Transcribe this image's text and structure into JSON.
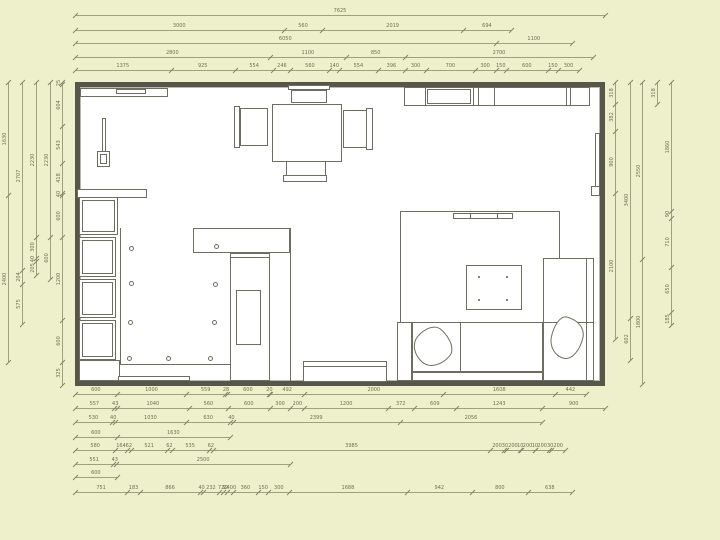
{
  "colors": {
    "background": "#eef0cb",
    "paper": "#ffffff",
    "wall": "#56564b",
    "furniture_line": "#6e6e60",
    "dimension_line": "#a0a080",
    "dimension_text": "#6f6f55"
  },
  "plan": {
    "x": 75,
    "y": 82,
    "w": 530,
    "h": 304,
    "scale_px_per_mm": 0.06951
  },
  "dims": {
    "top": [
      {
        "y": 15,
        "values": [
          7625
        ]
      },
      {
        "y": 30,
        "values": [
          3000,
          560,
          2019,
          694
        ]
      },
      {
        "y": 43,
        "values": [
          6050,
          1100
        ]
      },
      {
        "y": 57,
        "values": [
          2800,
          1100,
          850,
          2700
        ]
      },
      {
        "y": 70,
        "values": [
          1375,
          925,
          554,
          246,
          560,
          140,
          554,
          396,
          300,
          700,
          300,
          150,
          600,
          150,
          300
        ]
      }
    ],
    "bottom": [
      {
        "y": 394,
        "values": [
          600,
          1000,
          559,
          28,
          600,
          20,
          492,
          2000,
          1608,
          442
        ]
      },
      {
        "y": 408,
        "values": [
          557,
          43,
          1040,
          560,
          600,
          300,
          200,
          1200,
          372,
          609,
          1243,
          900
        ]
      },
      {
        "y": 422,
        "values": [
          530,
          40,
          1030,
          630,
          40,
          2399,
          2056
        ]
      },
      {
        "y": 437,
        "values": [
          600,
          1630
        ]
      },
      {
        "y": 450,
        "values": [
          580,
          164,
          62,
          521,
          62,
          535,
          62,
          3985,
          200,
          30,
          200,
          10,
          200,
          10,
          200,
          30,
          200
        ]
      },
      {
        "y": 464,
        "values": [
          551,
          43,
          2500
        ]
      },
      {
        "y": 477,
        "values": [
          600
        ]
      },
      {
        "y": 492,
        "values": [
          751,
          183,
          866,
          40,
          232,
          {
            "mm": 60,
            "label": "72"
          },
          {
            "mm": 50,
            "label": "32"
          },
          {
            "mm": 90,
            "label": "2400"
          },
          360,
          150,
          300,
          1688,
          942,
          800,
          638
        ]
      }
    ],
    "left": [
      {
        "x": 8,
        "values": [
          1630,
          2400
        ]
      },
      {
        "x": 22,
        "values": [
          2707,
          204,
          575
        ]
      },
      {
        "x": 36,
        "values": [
          2230,
          300,
          40,
          205
        ]
      },
      {
        "x": 50,
        "values": [
          2230,
          600
        ]
      },
      {
        "x": 62,
        "values": [
          25,
          604,
          543,
          418,
          40,
          600,
          1200,
          600,
          325
        ]
      }
    ],
    "right": [
      {
        "x": 615,
        "values": [
          318,
          382,
          900,
          2100
        ]
      },
      {
        "x": 630,
        "values": [
          3400,
          602
        ]
      },
      {
        "x": 642,
        "values": [
          2550,
          1800
        ]
      },
      {
        "x": 657,
        "values": [
          318
        ]
      },
      {
        "x": 671,
        "values": [
          1860,
          90,
          710,
          650,
          185
        ]
      }
    ]
  },
  "furniture": [
    {
      "name": "window-shelf",
      "type": "rect",
      "x": 80,
      "y": 88,
      "w": 88,
      "h": 9
    },
    {
      "name": "window-shelf-detail",
      "type": "rect",
      "x": 116,
      "y": 89,
      "w": 30,
      "h": 5
    },
    {
      "name": "wall-lamp-stem",
      "type": "rect",
      "x": 102,
      "y": 118,
      "w": 4,
      "h": 46
    },
    {
      "name": "wall-lamp-base",
      "type": "rect",
      "x": 97,
      "y": 151,
      "w": 13,
      "h": 16,
      "inner": true
    },
    {
      "name": "side-table",
      "type": "rect",
      "x": 77,
      "y": 189,
      "w": 70,
      "h": 9
    },
    {
      "name": "dining-table",
      "type": "rect",
      "x": 272,
      "y": 104,
      "w": 70,
      "h": 58
    },
    {
      "name": "chair-top-back",
      "type": "rect",
      "x": 288,
      "y": 85,
      "w": 42,
      "h": 5
    },
    {
      "name": "chair-top-seat",
      "type": "rect",
      "x": 291,
      "y": 90,
      "w": 36,
      "h": 13
    },
    {
      "name": "chair-left-back",
      "type": "rect",
      "x": 234,
      "y": 106,
      "w": 6,
      "h": 42
    },
    {
      "name": "chair-left-seat",
      "type": "rect",
      "x": 240,
      "y": 108,
      "w": 28,
      "h": 38
    },
    {
      "name": "chair-right-back",
      "type": "rect",
      "x": 366,
      "y": 108,
      "w": 7,
      "h": 42
    },
    {
      "name": "chair-right-seat",
      "type": "rect",
      "x": 343,
      "y": 110,
      "w": 24,
      "h": 38
    },
    {
      "name": "chair-bottom-back",
      "type": "rect",
      "x": 283,
      "y": 175,
      "w": 44,
      "h": 7
    },
    {
      "name": "chair-bottom-seat",
      "type": "rect",
      "x": 286,
      "y": 161,
      "w": 40,
      "h": 15
    },
    {
      "name": "kitchen-cabinet-row",
      "type": "rect",
      "x": 404,
      "y": 87,
      "w": 186,
      "h": 19
    },
    {
      "name": "cabinet-divider",
      "type": "line",
      "x": 425,
      "y": 87,
      "w": 1,
      "h": 19
    },
    {
      "name": "cabinet-divider",
      "type": "line",
      "x": 473,
      "y": 87,
      "w": 1,
      "h": 19
    },
    {
      "name": "cabinet-divider",
      "type": "line",
      "x": 478,
      "y": 87,
      "w": 1,
      "h": 19
    },
    {
      "name": "cabinet-divider",
      "type": "line",
      "x": 494,
      "y": 87,
      "w": 1,
      "h": 19
    },
    {
      "name": "cabinet-divider",
      "type": "line",
      "x": 566,
      "y": 87,
      "w": 1,
      "h": 19
    },
    {
      "name": "cabinet-divider",
      "type": "line",
      "x": 570,
      "y": 87,
      "w": 1,
      "h": 19
    },
    {
      "name": "cabinet-inner",
      "type": "rect",
      "x": 427,
      "y": 89,
      "w": 44,
      "h": 15
    },
    {
      "name": "radiator-right",
      "type": "rect",
      "x": 595,
      "y": 133,
      "w": 5,
      "h": 59
    },
    {
      "name": "radiator-right-foot",
      "type": "rect",
      "x": 591,
      "y": 186,
      "w": 9,
      "h": 10
    },
    {
      "name": "left-cabinet-box",
      "type": "rect",
      "x": 79,
      "y": 197,
      "w": 39,
      "h": 38,
      "inner": true
    },
    {
      "name": "left-cabinet-box",
      "type": "rect",
      "x": 79,
      "y": 237,
      "w": 37,
      "h": 40,
      "inner": true
    },
    {
      "name": "left-cabinet-box",
      "type": "rect",
      "x": 79,
      "y": 279,
      "w": 37,
      "h": 39,
      "inner": true
    },
    {
      "name": "left-cabinet-box",
      "type": "rect",
      "x": 79,
      "y": 320,
      "w": 37,
      "h": 40,
      "inner": true
    },
    {
      "name": "left-cabinet-base",
      "type": "rect",
      "x": 79,
      "y": 360,
      "w": 41,
      "h": 21
    },
    {
      "name": "zone-line-vertical",
      "type": "line",
      "x": 120,
      "y": 228,
      "w": 1,
      "h": 137
    },
    {
      "name": "zone-line-bottom",
      "type": "line",
      "x": 120,
      "y": 364,
      "w": 110,
      "h": 1
    },
    {
      "name": "counter",
      "type": "rect",
      "x": 193,
      "y": 228,
      "w": 97,
      "h": 25
    },
    {
      "name": "partition-wall",
      "type": "line",
      "x": 290,
      "y": 228,
      "w": 1,
      "h": 153
    },
    {
      "name": "wardrobe",
      "type": "rect",
      "x": 230,
      "y": 253,
      "w": 40,
      "h": 128
    },
    {
      "name": "wardrobe-door",
      "type": "rect",
      "x": 230,
      "y": 253,
      "w": 40,
      "h": 5
    },
    {
      "name": "wardrobe-inner",
      "type": "rect",
      "x": 236,
      "y": 290,
      "w": 25,
      "h": 55
    },
    {
      "name": "bench",
      "type": "rect",
      "x": 303,
      "y": 361,
      "w": 84,
      "h": 21
    },
    {
      "name": "bench-top",
      "type": "rect",
      "x": 303,
      "y": 361,
      "w": 84,
      "h": 6
    },
    {
      "name": "rug",
      "type": "rect",
      "x": 400,
      "y": 211,
      "w": 160,
      "h": 112
    },
    {
      "name": "tv-console",
      "type": "rect",
      "x": 453,
      "y": 213,
      "w": 60,
      "h": 6
    },
    {
      "name": "tv-console-divider",
      "type": "line",
      "x": 470,
      "y": 213,
      "w": 1,
      "h": 6
    },
    {
      "name": "tv-console-divider",
      "type": "line",
      "x": 497,
      "y": 213,
      "w": 1,
      "h": 6
    },
    {
      "name": "coffee-table",
      "type": "rect",
      "x": 466,
      "y": 265,
      "w": 56,
      "h": 45
    },
    {
      "name": "sofa-armrest-left",
      "type": "rect",
      "x": 397,
      "y": 322,
      "w": 15,
      "h": 59
    },
    {
      "name": "sofa-seat",
      "type": "rect",
      "x": 412,
      "y": 322,
      "w": 131,
      "h": 50
    },
    {
      "name": "sofa-seat-divider",
      "type": "line",
      "x": 460,
      "y": 322,
      "w": 1,
      "h": 50
    },
    {
      "name": "sofa-front",
      "type": "rect",
      "x": 412,
      "y": 372,
      "w": 131,
      "h": 9
    },
    {
      "name": "sofa-right-section",
      "type": "rect",
      "x": 543,
      "y": 258,
      "w": 51,
      "h": 123
    },
    {
      "name": "sofa-right-divider",
      "type": "line",
      "x": 543,
      "y": 322,
      "w": 51,
      "h": 1
    },
    {
      "name": "sofa-right-armrest",
      "type": "line",
      "x": 586,
      "y": 258,
      "w": 1,
      "h": 123
    },
    {
      "name": "door-threshold",
      "type": "rect",
      "x": 118,
      "y": 376,
      "w": 72,
      "h": 5
    }
  ],
  "spotlights": [
    [
      131,
      248
    ],
    [
      131,
      283
    ],
    [
      130,
      322
    ],
    [
      129,
      358
    ],
    [
      168,
      358
    ],
    [
      210,
      358
    ],
    [
      216,
      246
    ],
    [
      215,
      284
    ],
    [
      214,
      322
    ]
  ],
  "table_dots": [
    [
      479,
      277
    ],
    [
      507,
      277
    ],
    [
      479,
      300
    ],
    [
      507,
      300
    ]
  ],
  "pillows": [
    {
      "cx": 433,
      "cy": 347,
      "w": 38,
      "h": 38,
      "rot": 40
    },
    {
      "cx": 567,
      "cy": 338,
      "w": 32,
      "h": 42,
      "rot": 12
    }
  ]
}
